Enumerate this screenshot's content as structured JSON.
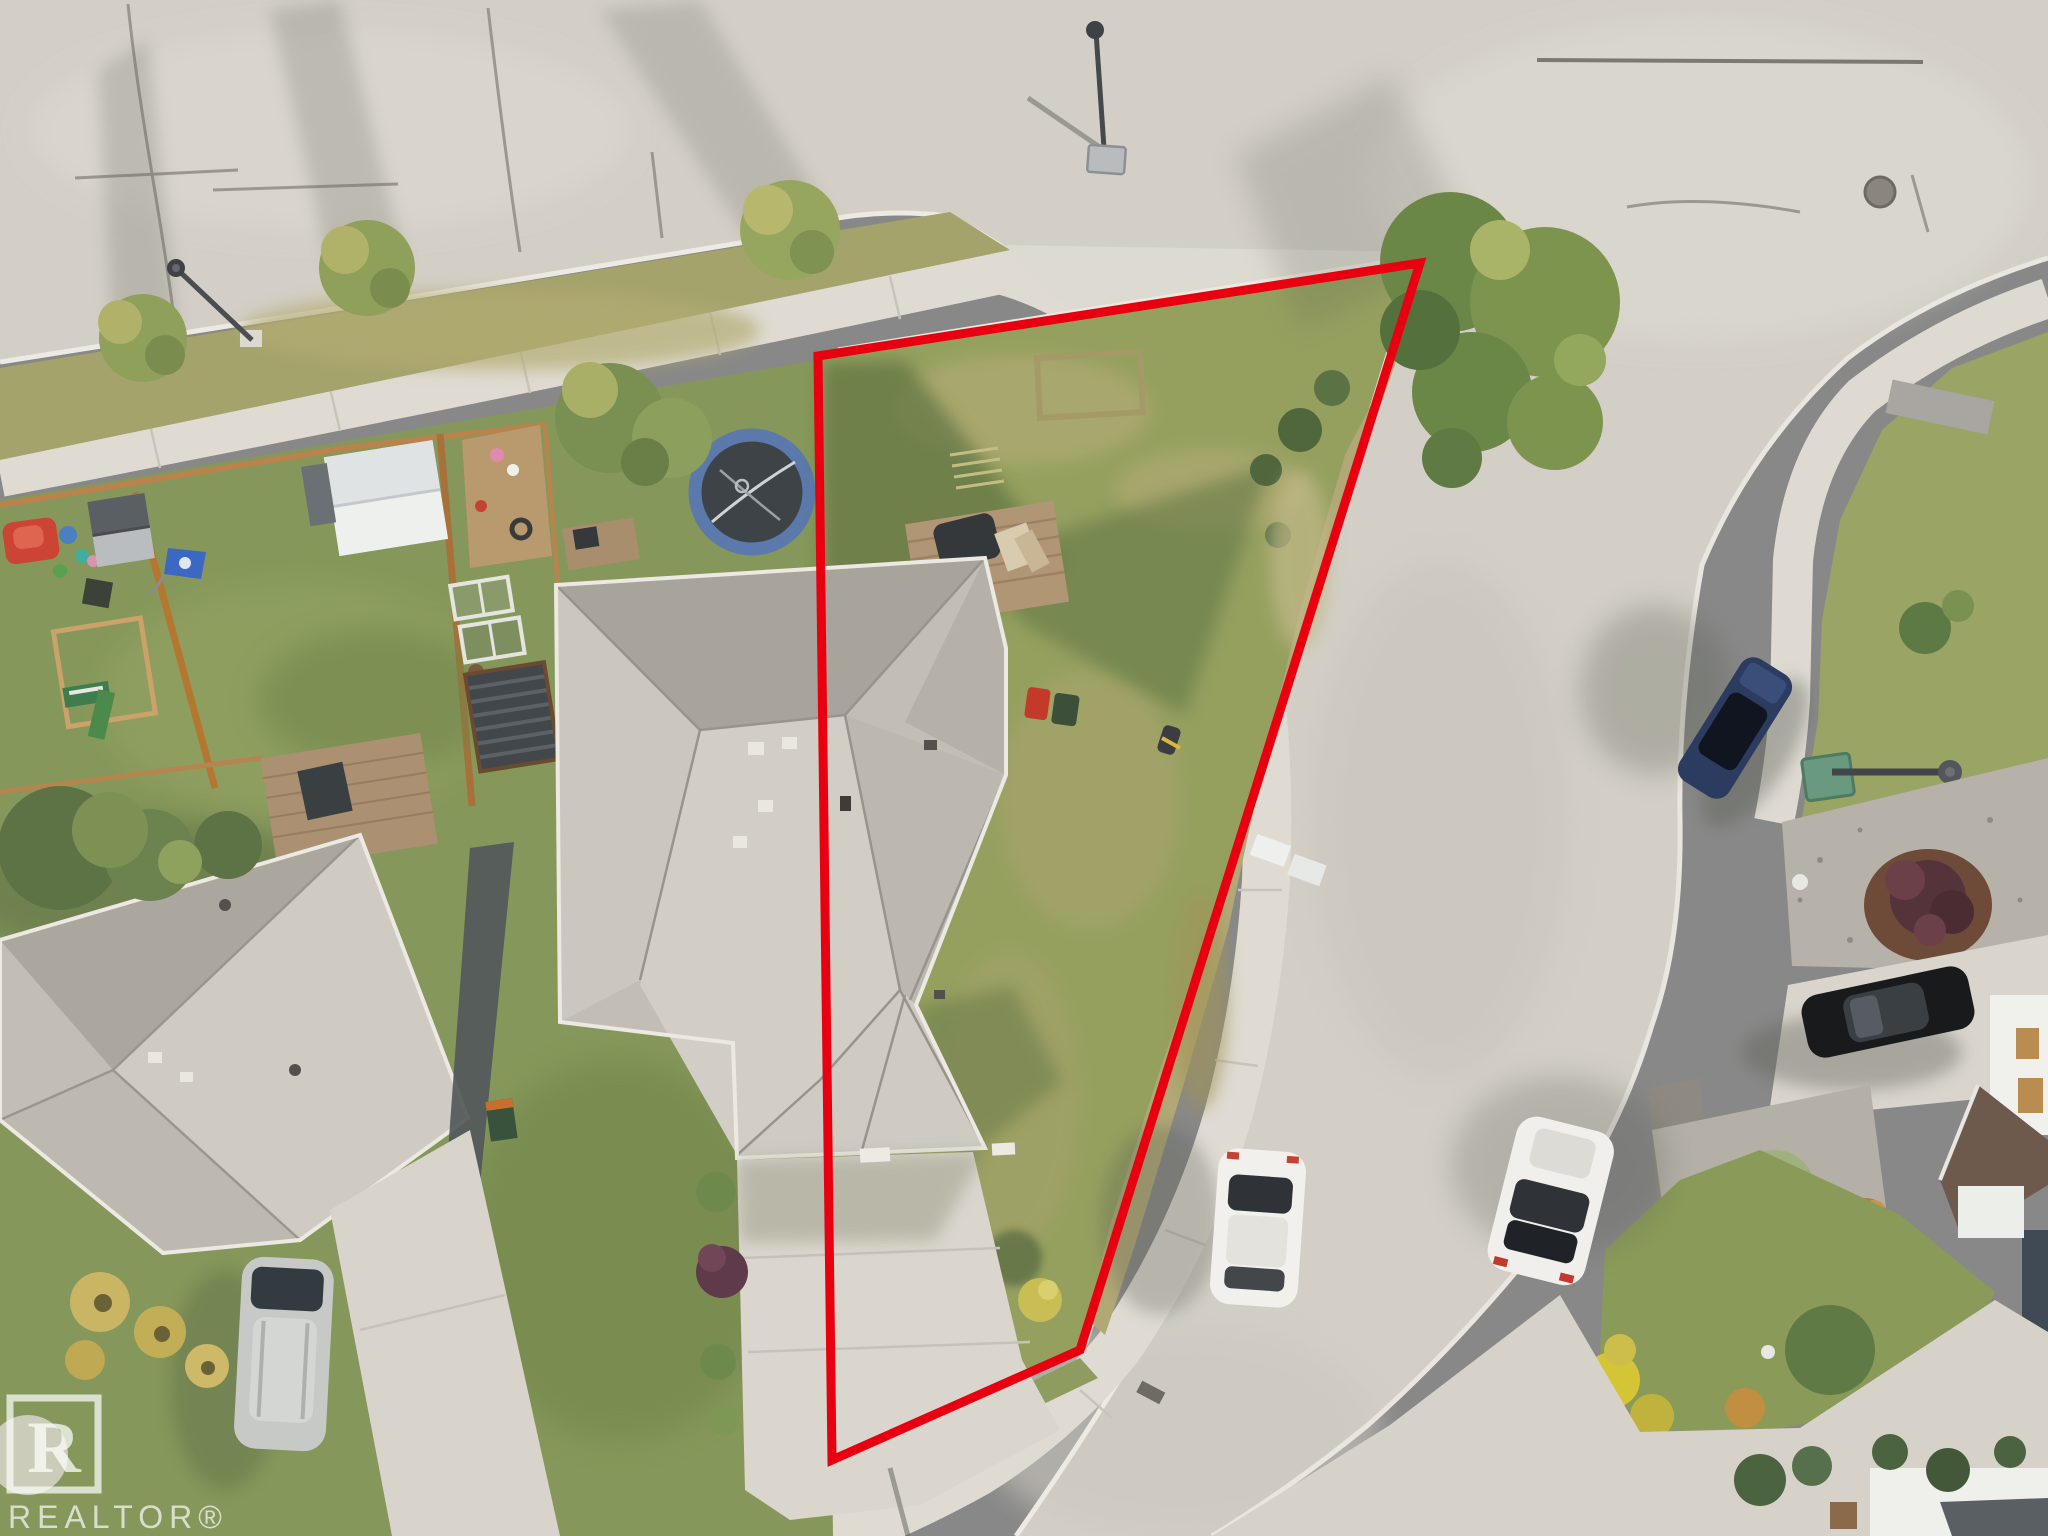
{
  "watermark": {
    "text": "REALTOR®",
    "logo_letter": "R"
  },
  "boundary": {
    "color": "#e80010",
    "meaning": "outlined property lot boundary (half-duplex corner lot)"
  },
  "palette": {
    "road": "#d3cfc6",
    "sidewalk": "#dfdbd2",
    "grass": "#85975a",
    "lot_grass": "#95a05f",
    "dry_grass": "#b2a876",
    "roof": "#c2beb6",
    "roof_shade": "#a8a49b",
    "roof_light": "#d2cec6",
    "trampoline_ring": "#5b79ab",
    "navy_suv": "#2c3c60",
    "black_sedan": "#181a1c",
    "white_car": "#f1f0ec",
    "silver_van": "#c7c9c7"
  },
  "scene": {
    "type": "aerial-drone-photo",
    "description": "Top-down aerial photo of a suburban corner lot; red boundary outlines a half-duplex property beside a curved street",
    "objects": [
      "red-property-boundary",
      "subject-duplex-roof",
      "shared-driveway",
      "backyard-lawn",
      "rear-deck-with-tarp",
      "garbage-bins",
      "neighbor-trampoline",
      "neighbor-sheds",
      "neighbor-playset",
      "southwest-neighbor-roof",
      "silver-minivan",
      "navy-suv",
      "black-sedan",
      "white-hatchback",
      "white-sedan",
      "street-lights",
      "boulevard-trees",
      "corner-tree",
      "gravel-beds",
      "maroon-shrub",
      "realtor-watermark"
    ]
  }
}
